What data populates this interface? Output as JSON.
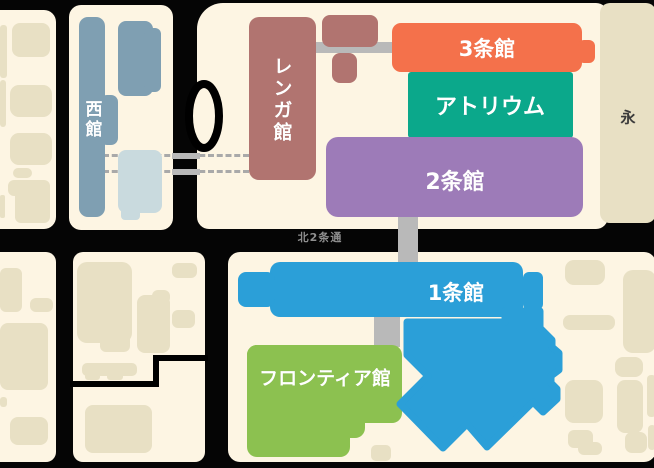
{
  "map": {
    "name": "sapporo-factory-area-map",
    "buildings": [
      {
        "id": "west-hall",
        "label": "西館",
        "color": "#7f9fb2",
        "orientation": "vertical"
      },
      {
        "id": "renga-hall",
        "label": "レンガ館",
        "color": "#b17470",
        "orientation": "vertical"
      },
      {
        "id": "3jo-hall",
        "label": "3条館",
        "color": "#f4714b",
        "orientation": "horizontal"
      },
      {
        "id": "atrium",
        "label": "アトリウム",
        "color": "#0ba88b",
        "orientation": "horizontal"
      },
      {
        "id": "2jo-hall",
        "label": "2条館",
        "color": "#9d7bb8",
        "orientation": "horizontal"
      },
      {
        "id": "1jo-hall",
        "label": "1条館",
        "color": "#2b9fd8",
        "orientation": "horizontal"
      },
      {
        "id": "frontier-hall",
        "label": "フロンティア館",
        "color": "#8cc150",
        "orientation": "horizontal"
      }
    ],
    "labels": {
      "street": "北2条通",
      "district": "永"
    },
    "palette": {
      "background_road": "#050505",
      "city_block": "#fdf5e3",
      "generic_building": "#e8e0c4",
      "annex_building": "#2b9fd8",
      "west_annex_light": "#c9dade",
      "connector_gray": "#b9b9b9",
      "street_label_gray": "#8f8f8f",
      "district_text": "#3a3a3a"
    }
  }
}
